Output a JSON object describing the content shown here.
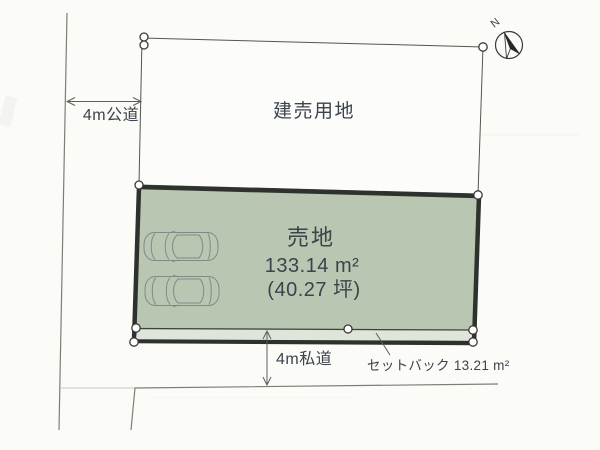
{
  "diagram": {
    "compass": {
      "north_label": "N",
      "icon": "compass-north-icon"
    },
    "upper_lot": {
      "label": "建売用地"
    },
    "sale_lot": {
      "label": "売地",
      "area_sqm": "133.14 m²",
      "area_tsubo": "(40.27 坪)",
      "parked_cars": 2,
      "car_icon": "car-top-view-icon"
    },
    "roads": {
      "left_label": "4m公道",
      "bottom_label": "4m私道"
    },
    "setback": {
      "label": "セットバック 13.21 m²"
    },
    "colors": {
      "lot_fill": "#b9c6b1",
      "setback_fill": "#e0e5db",
      "border_dark": "#2e322c",
      "line_gray": "#6d6d68",
      "text_dark": "#3b434b",
      "paper": "#fbfbf8"
    }
  }
}
